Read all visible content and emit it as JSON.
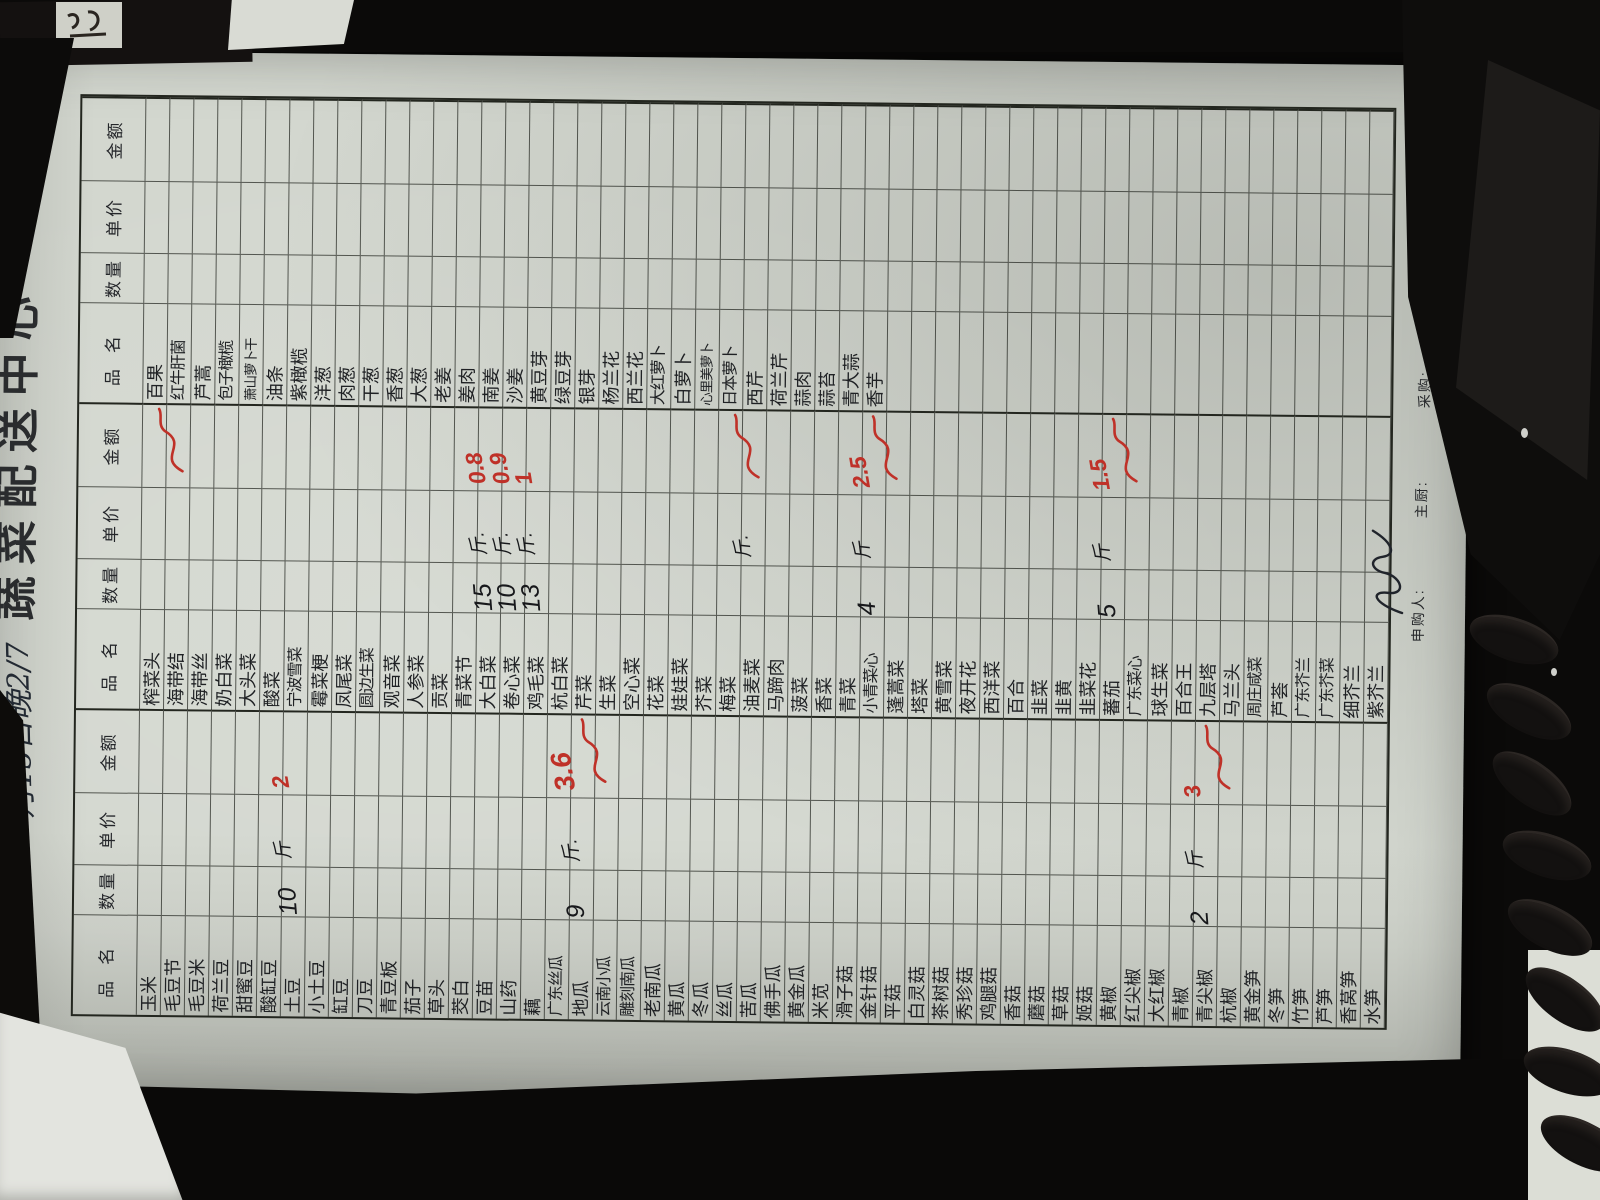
{
  "page": {
    "title": "蔬菜配送中心",
    "date_note": "月15日晚2/7"
  },
  "table": {
    "header": [
      "品名",
      "数量",
      "单价",
      "金额"
    ],
    "groups": [
      {
        "items": [
          "玉米",
          "毛豆节",
          "毛豆米",
          "荷兰豆",
          "甜蜜豆",
          "酸缸豆",
          "土豆",
          "小土豆",
          "缸豆",
          "刀豆",
          "青豆板",
          "茄子",
          "草头",
          "茭白",
          "豆苗",
          "山药",
          "藕",
          "广东丝瓜",
          "地瓜",
          "云南小瓜",
          "雕刻南瓜",
          "老南瓜",
          "黄瓜",
          "冬瓜",
          "丝瓜",
          "苦瓜",
          "佛手瓜",
          "黄金瓜",
          "米苋",
          "滑子菇",
          "金针菇",
          "平菇",
          "白灵菇",
          "茶树菇",
          "秀珍菇",
          "鸡腿菇",
          "香菇",
          "蘑菇",
          "草菇",
          "姬菇",
          "黄椒",
          "红尖椒",
          "大红椒",
          "青椒",
          "青尖椒",
          "杭椒",
          "黄金笋",
          "冬笋",
          "竹笋",
          "芦笋",
          "香莴笋",
          "水笋"
        ]
      },
      {
        "items": [
          "榨菜头",
          "海带结",
          "海带丝",
          "奶白菜",
          "大头菜",
          "酸菜",
          "宁波雪菜",
          "霉菜梗",
          "凤尾菜",
          "圆边生菜",
          "观音菜",
          "人参菜",
          "贡菜",
          "青菜节",
          "大白菜",
          "卷心菜",
          "鸡毛菜",
          "杭白菜",
          "芹菜",
          "生菜",
          "空心菜",
          "花菜",
          "娃娃菜",
          "芥菜",
          "梅菜",
          "油麦菜",
          "马蹄肉",
          "菠菜",
          "香菜",
          "青菜",
          "小青菜心",
          "蓬蒿菜",
          "塔菜",
          "黄雪菜",
          "夜开花",
          "西洋菜",
          "百合",
          "韭菜",
          "韭黄",
          "韭菜花",
          "蕃茄",
          "广东菜心",
          "球生菜",
          "百合王",
          "九层塔",
          "马兰头",
          "周庄咸菜",
          "芦荟",
          "广东芥兰",
          "广东芥菜",
          "细芥兰",
          "紫芥兰"
        ]
      },
      {
        "items": [
          "百果",
          "红牛肝菌",
          "芦蒿",
          "包子橄榄",
          "萧山萝卜干",
          "油条",
          "紫橄榄",
          "洋葱",
          "肉葱",
          "干葱",
          "香葱",
          "大葱",
          "老姜",
          "姜肉",
          "南姜",
          "沙姜",
          "黄豆芽",
          "绿豆芽",
          "银芽",
          "杨兰花",
          "西兰花",
          "大红萝卜",
          "白萝卜",
          "心里美萝卜",
          "日本萝卜",
          "西芹",
          "荷兰芹",
          "蒜肉",
          "蒜苔",
          "青大蒜",
          "香芋",
          "",
          "",
          "",
          "",
          "",
          "",
          "",
          "",
          "",
          "",
          "",
          "",
          "",
          "",
          "",
          "",
          "",
          "",
          "",
          "",
          ""
        ]
      }
    ]
  },
  "annotations": [
    {
      "group": 0,
      "row": "土豆",
      "idx": 6,
      "qty": "10",
      "unit": "斤",
      "amount": "2",
      "scrawl": false,
      "big": false
    },
    {
      "group": 0,
      "row": "地瓜",
      "idx": 18,
      "qty": "9",
      "unit": "斤.",
      "amount": "3.6",
      "scrawl": true,
      "big": true
    },
    {
      "group": 0,
      "row": "青尖椒",
      "idx": 44,
      "qty": "2",
      "unit": "斤",
      "amount": "3",
      "scrawl": true,
      "big": false
    },
    {
      "group": 1,
      "row": "海带结",
      "idx": 1,
      "qty": "",
      "unit": "",
      "amount": "",
      "scrawl": true,
      "big": false
    },
    {
      "group": 1,
      "row": "大白菜",
      "idx": 14,
      "qty": "15",
      "unit": "斤.",
      "amount": "0.8",
      "scrawl": false,
      "big": false
    },
    {
      "group": 1,
      "row": "卷心菜",
      "idx": 15,
      "qty": "10",
      "unit": "斤.",
      "amount": "0.9",
      "scrawl": false,
      "big": false
    },
    {
      "group": 1,
      "row": "鸡毛菜",
      "idx": 16,
      "qty": "13",
      "unit": "斤.",
      "amount": "1",
      "scrawl": false,
      "big": false
    },
    {
      "group": 1,
      "row": "油麦菜",
      "idx": 25,
      "qty": "",
      "unit": "斤.",
      "amount": "",
      "scrawl": true,
      "big": false
    },
    {
      "group": 1,
      "row": "小青菜心",
      "idx": 30,
      "qty": "4",
      "unit": "斤",
      "amount": "2.5",
      "scrawl": true,
      "big": false
    },
    {
      "group": 1,
      "row": "蕃茄",
      "idx": 40,
      "qty": "5",
      "unit": "斤",
      "amount": "1.5",
      "scrawl": true,
      "big": false
    }
  ],
  "footer": {
    "labels": [
      "申购人:",
      "主厨:",
      "采购:",
      "验收:"
    ],
    "signature": "孙"
  }
}
